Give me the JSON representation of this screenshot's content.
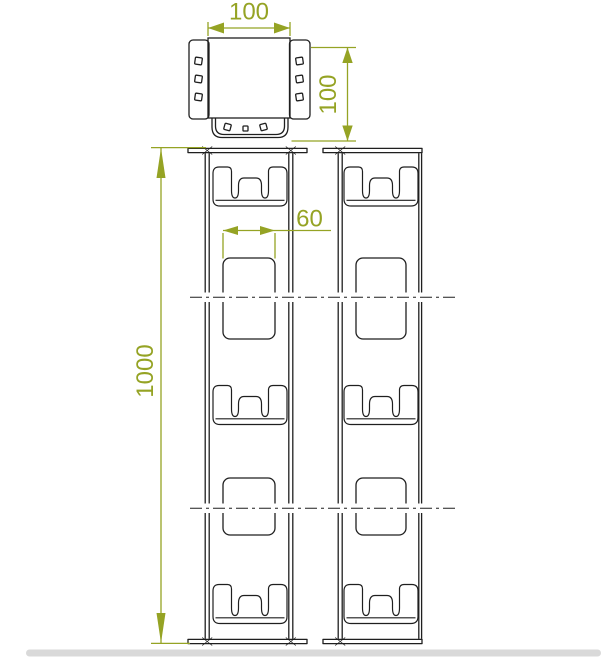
{
  "colors": {
    "line": "#1f1f1f",
    "accent": "#95a324",
    "scrollbar": "#d9d9d9",
    "white": "#ffffff"
  },
  "dimensions": {
    "top_width": "100",
    "top_height": "100",
    "slot_width": "60",
    "length": "1000"
  }
}
